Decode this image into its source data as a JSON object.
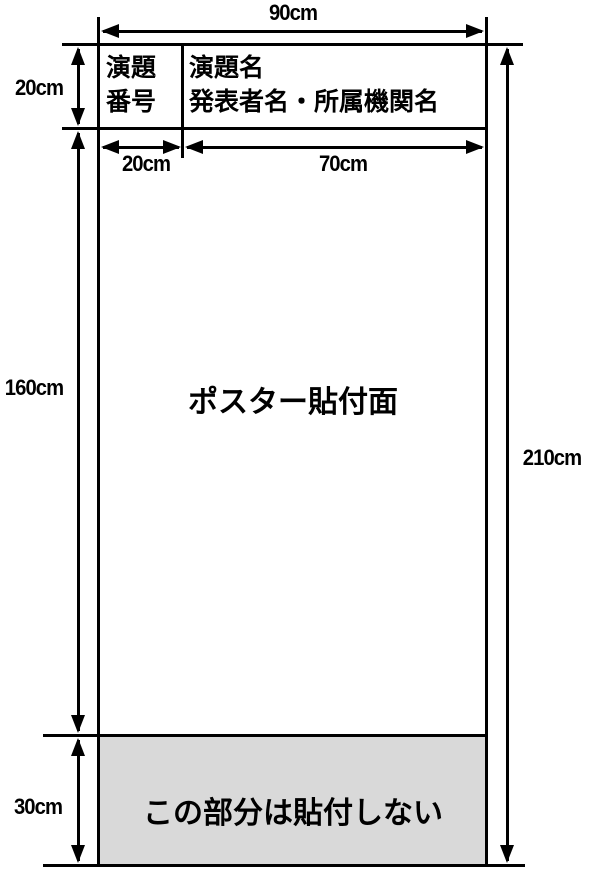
{
  "diagram": {
    "description_type": "poster-board-dimension-diagram",
    "colors": {
      "line": "#000000",
      "background": "#ffffff",
      "no_paste_bg": "#d9d9d9",
      "text": "#000000"
    },
    "board": {
      "header": {
        "number_cell_label": "演題\n番号",
        "title_cell_label": "演題名\n発表者名・所属機関名"
      },
      "poster_area_label": "ポスター貼付面",
      "no_paste_area_label": "この部分は貼付しない"
    },
    "dimensions": {
      "total_width": "90cm",
      "header_height": "20cm",
      "number_cell_width": "20cm",
      "title_cell_width": "70cm",
      "poster_area_height": "160cm",
      "total_height": "210cm",
      "no_paste_height": "30cm"
    }
  }
}
